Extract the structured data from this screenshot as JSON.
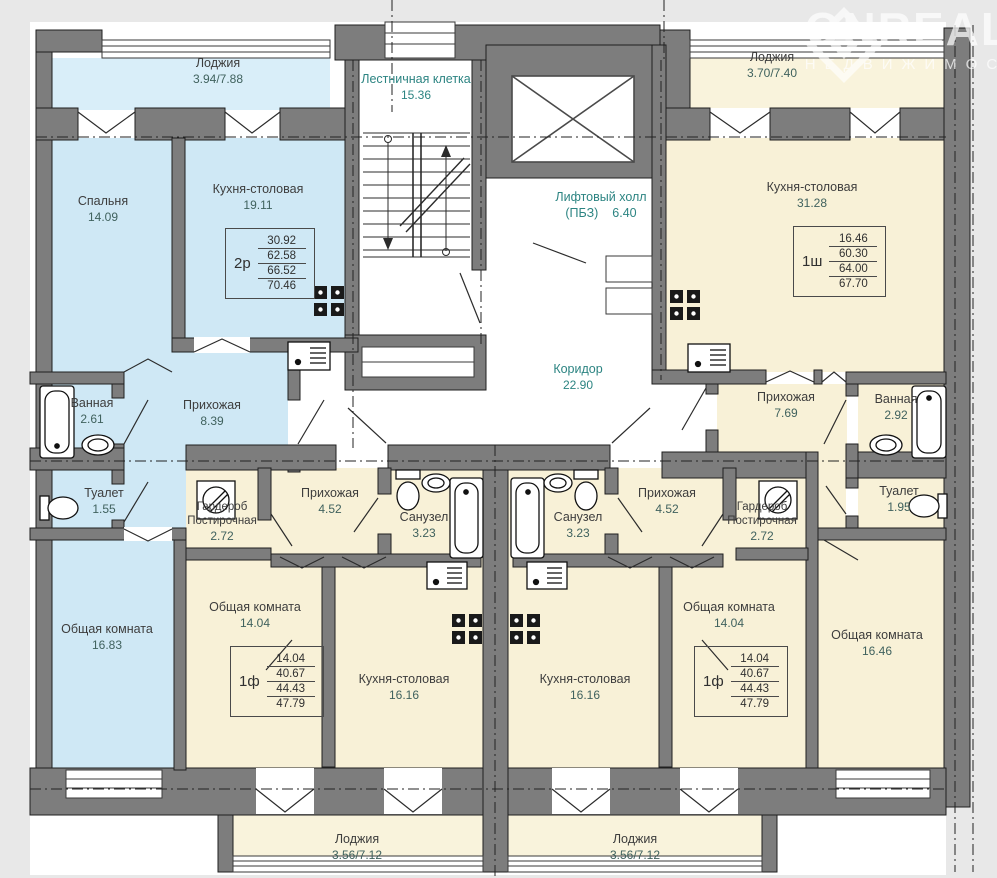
{
  "colors": {
    "apartment_blue": "#cfe8f5",
    "loggia_blue": "#d9eef9",
    "apartment_cream": "#f8f1d7",
    "loggia_cream": "#f9f3dc",
    "wall_gray": "#7d7d7d",
    "accent_teal": "#2c8482",
    "page_bg": "#e8e8e8"
  },
  "watermark": {
    "brand": "ONREAL",
    "tagline": "НЕДВИЖИМОС"
  },
  "common_areas": {
    "staircase": {
      "name": "Лестничная клетка",
      "area": "15.36"
    },
    "lift_hall": {
      "name": "Лифтовый холл",
      "code": "(ПБЗ)",
      "area": "6.40"
    },
    "corridor": {
      "name": "Коридор",
      "area": "22.90"
    }
  },
  "apartments": {
    "left_2r": {
      "type": "2р",
      "totals": [
        "30.92",
        "62.58",
        "66.52",
        "70.46"
      ],
      "rooms": {
        "loggia": {
          "name": "Лоджия",
          "area": "3.94/7.88"
        },
        "bedroom": {
          "name": "Спальня",
          "area": "14.09"
        },
        "kitchen": {
          "name": "Кухня-столовая",
          "area": "19.11"
        },
        "hallway": {
          "name": "Прихожая",
          "area": "8.39"
        },
        "bathroom": {
          "name": "Ванная",
          "area": "2.61"
        },
        "wc": {
          "name": "Туалет",
          "area": "1.55"
        },
        "living": {
          "name": "Общая комната",
          "area": "16.83"
        }
      }
    },
    "right_1sh": {
      "type": "1ш",
      "totals": [
        "16.46",
        "60.30",
        "64.00",
        "67.70"
      ],
      "rooms": {
        "loggia": {
          "name": "Лоджия",
          "area": "3.70/7.40"
        },
        "kitchen": {
          "name": "Кухня-столовая",
          "area": "31.28"
        },
        "hallway": {
          "name": "Прихожая",
          "area": "7.69"
        },
        "bathroom": {
          "name": "Ванная",
          "area": "2.92"
        },
        "wc": {
          "name": "Туалет",
          "area": "1.95"
        },
        "living": {
          "name": "Общая комната",
          "area": "16.46"
        }
      }
    },
    "bottom_left_1f": {
      "type": "1ф",
      "totals": [
        "14.04",
        "40.67",
        "44.43",
        "47.79"
      ],
      "rooms": {
        "wardrobe": {
          "name": "Гардероб",
          "name2": "Постирочная",
          "area": "2.72"
        },
        "hallway": {
          "name": "Прихожая",
          "area": "4.52"
        },
        "sanuzel": {
          "name": "Санузел",
          "area": "3.23"
        },
        "living": {
          "name": "Общая комната",
          "area": "14.04"
        },
        "kitchen": {
          "name": "Кухня-столовая",
          "area": "16.16"
        },
        "loggia": {
          "name": "Лоджия",
          "area": "3.56/7.12"
        }
      }
    },
    "bottom_right_1f": {
      "type": "1ф",
      "totals": [
        "14.04",
        "40.67",
        "44.43",
        "47.79"
      ],
      "rooms": {
        "wardrobe": {
          "name": "Гардероб",
          "name2": "Постирочная",
          "area": "2.72"
        },
        "hallway": {
          "name": "Прихожая",
          "area": "4.52"
        },
        "sanuzel": {
          "name": "Санузел",
          "area": "3.23"
        },
        "living": {
          "name": "Общая комната",
          "area": "14.04"
        },
        "kitchen": {
          "name": "Кухня-столовая",
          "area": "16.16"
        },
        "loggia": {
          "name": "Лоджия",
          "area": "3.56/7.12"
        }
      }
    }
  }
}
